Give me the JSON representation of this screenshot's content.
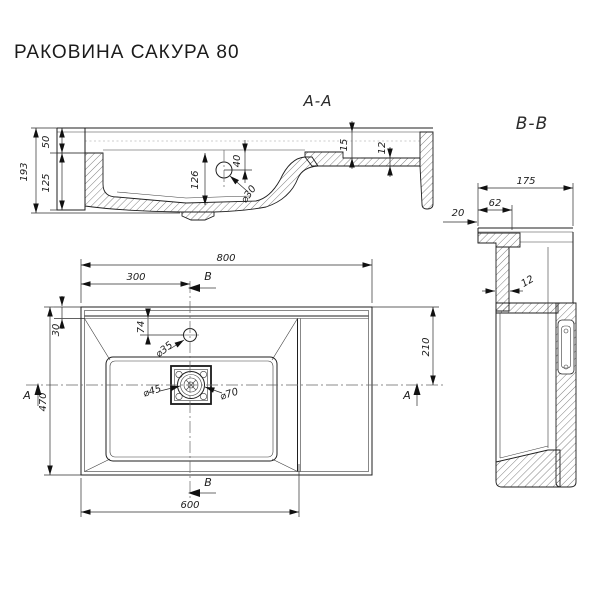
{
  "title": "РАКОВИНА САКУРА 80",
  "sections": {
    "aa": {
      "label": "А-А",
      "dims": {
        "total_height": "193",
        "top_height": "50",
        "mid_height": "125",
        "bowl_depth": "126",
        "overflow_offset": "40",
        "overflow_dia": "⌀30",
        "ledge_drop": "15",
        "ledge_thickness": "12"
      }
    },
    "bb": {
      "label": "В-В",
      "dims": {
        "depth": "175",
        "front_offset": "62",
        "edge_offset": "20",
        "wall_thickness": "12"
      }
    }
  },
  "plan": {
    "dims": {
      "overall_width": "800",
      "faucet_from_left": "300",
      "back_rim": "30",
      "overall_depth": "470",
      "faucet_from_back": "74",
      "faucet_dia": "⌀35",
      "drain_inner_dia": "⌀45",
      "drain_outer_dia": "⌀70",
      "right_to_center": "210",
      "bowl_section_width": "600"
    },
    "markers": {
      "a_left": "А",
      "a_right": "А",
      "b_top": "В",
      "b_bottom": "В"
    }
  }
}
